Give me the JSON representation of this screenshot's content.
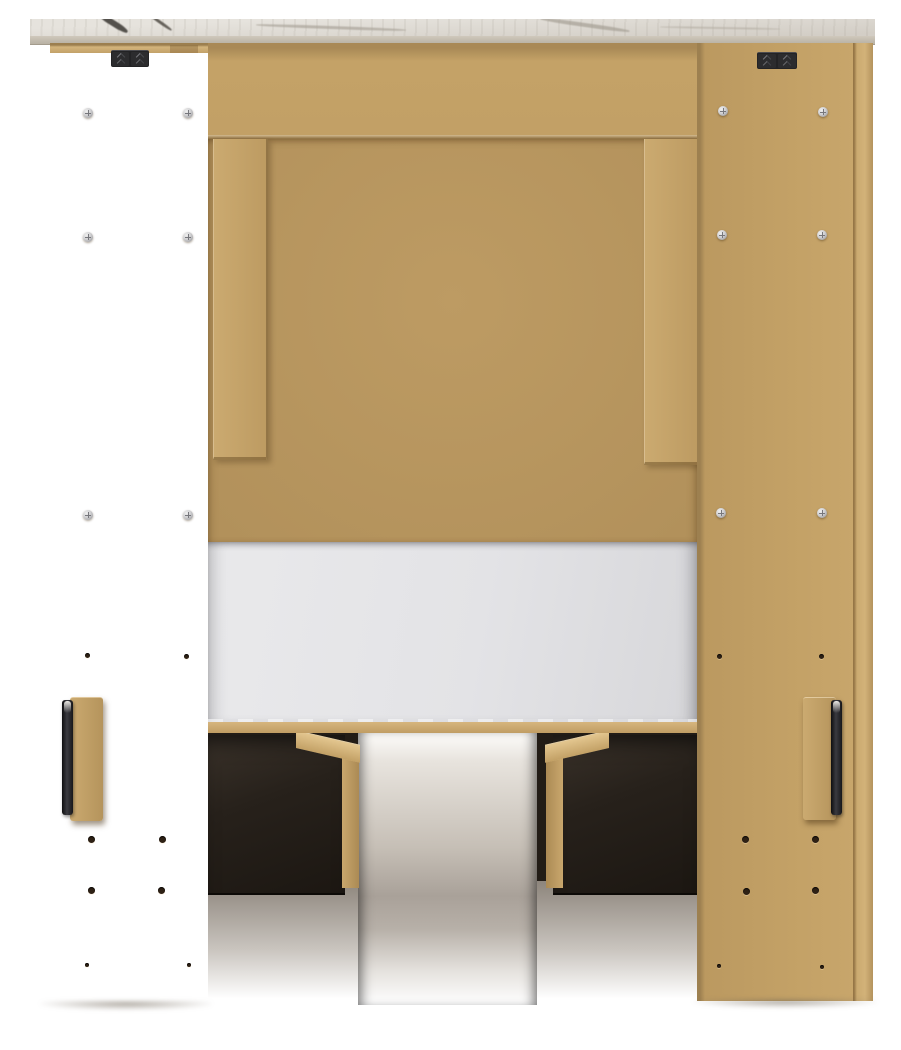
{
  "meta": {
    "description": "Back view product photograph of a panel bed with bookcase headboard, marble-look top panel and two under-bed storage drawers",
    "image_type": "furniture-product-photo",
    "visible_text": ""
  },
  "components": {
    "top_panel": "marble-look top panel",
    "top_edge_strip": "panel top edge",
    "back_rail": "upper back rail",
    "back_panel": "center back panel",
    "battens": "vertical mounting battens",
    "left_side_panel": "left side panel",
    "right_side_panel": "right side panel",
    "brackets": "black metal connector brackets",
    "screws": "silver phillips screws",
    "holes": "pre-drilled pilot holes",
    "mattress": "white mattress",
    "platform_deck": "platform deck edge",
    "drawers": "dark under-bed storage drawers",
    "drawer_runners": "wood drawer runners",
    "handle_blocks": "wood handle mounting blocks",
    "handle_bars": "dark metal handle rails",
    "floor": "studio floor"
  },
  "counts": {
    "screws": 12,
    "pilot_holes": 16,
    "drawers": 2,
    "brackets": 2,
    "battens": 2,
    "handles": 2
  },
  "colors": {
    "background": "#ffffff",
    "marble_top": "#e6e3dd",
    "marble_shade": "#d3cec6",
    "marble_edge": "#cfc8bc",
    "vein_dark": "#45423d",
    "vein_soft": "#aaa49a",
    "top_edge_strip": "#d3b47c",
    "mdf": "#c4a267",
    "mdf_light": "#cbaa70",
    "mdf_dark": "#a88956",
    "panel_center": "#bd9b63",
    "bracket_dark": "#232325",
    "screw_silver": "#cfcfd1",
    "hole_dark": "#2e2115",
    "mattress": "#e9e9eb",
    "mattress_shade": "#d7d7da",
    "deck": "#d6b57e",
    "under_dark": "#221c16",
    "drawer_front": "#27211b",
    "runner": "#c9a76d",
    "floor": "#8d857c",
    "handle_dark": "#3a3a40"
  }
}
